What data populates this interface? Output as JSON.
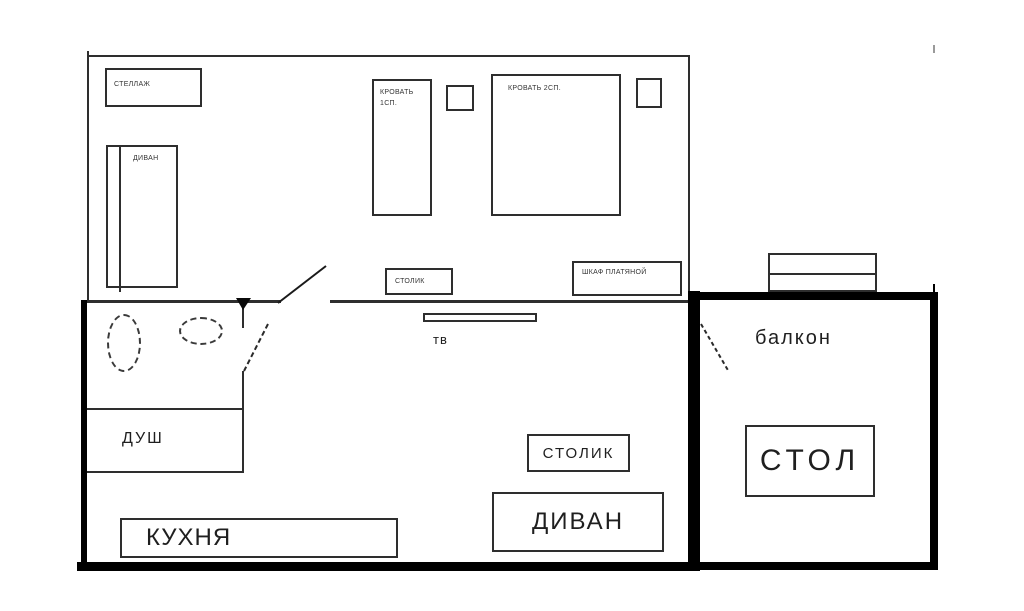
{
  "colors": {
    "background": "#ffffff",
    "thin_line": "#2e2e2e",
    "thick_wall": "#000000"
  },
  "bedroom": {
    "shelf": "СТЕЛЛАЖ",
    "sofa": "ДИВАН",
    "bed_single_line1": "КРОВАТЬ",
    "bed_single_line2": "1СП.",
    "bed_double": "КРОВАТЬ 2СП.",
    "side_table": "СТОЛИК",
    "wardrobe": "ШКАФ ПЛАТЯНОЙ"
  },
  "bathroom": {
    "shower": "ДУШ"
  },
  "living_room": {
    "tv": "тв",
    "coffee_table": "СТОЛИК",
    "sofa": "ДИВАН",
    "kitchen": "КУХНЯ"
  },
  "balcony": {
    "name": "балкон",
    "table": "СТОЛ"
  }
}
